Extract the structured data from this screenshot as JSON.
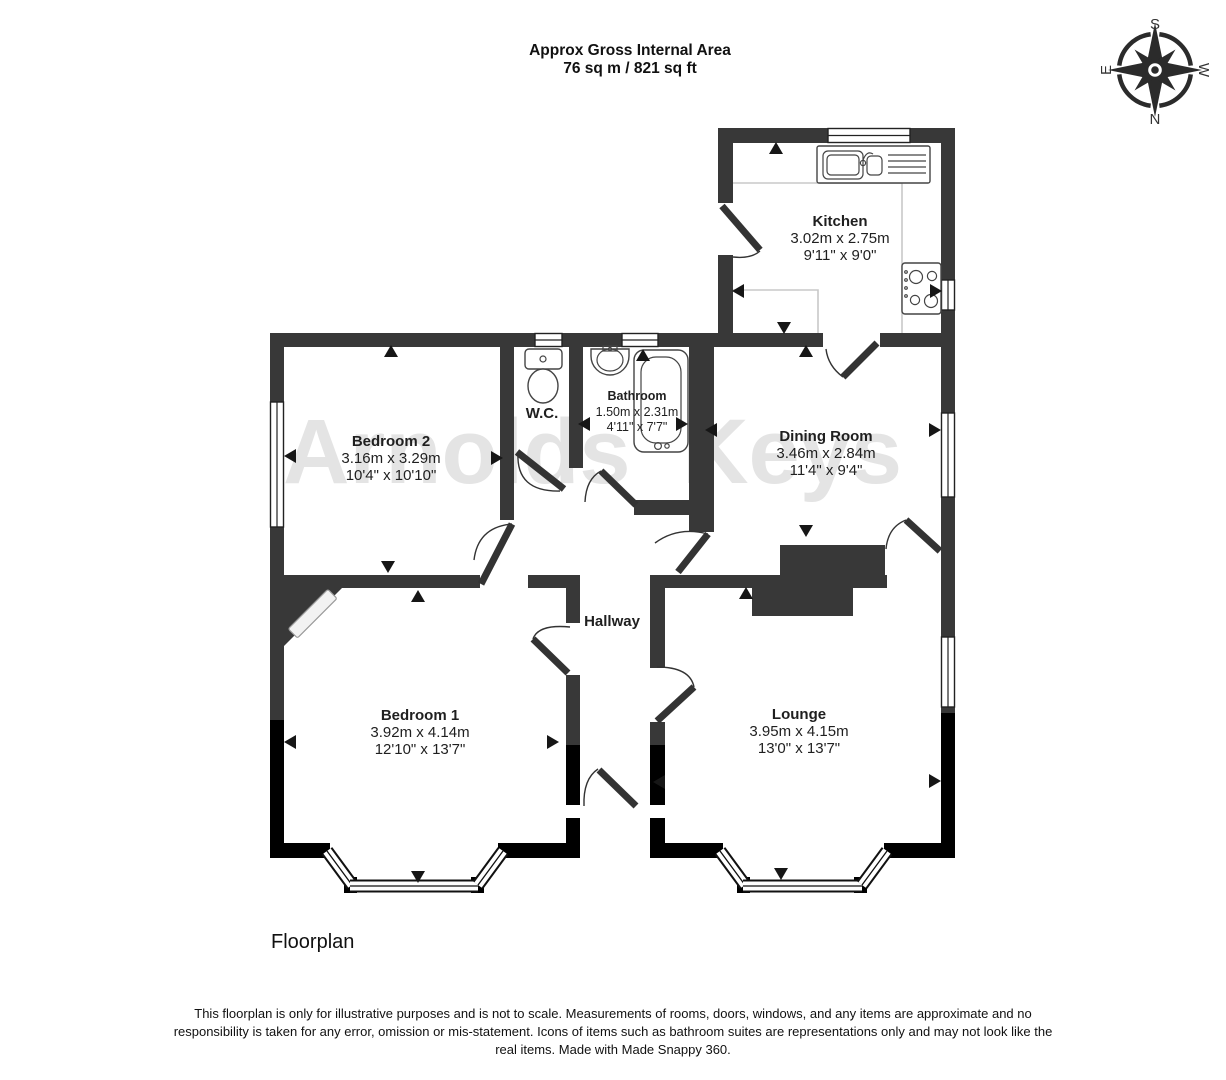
{
  "header": {
    "title_line1": "Approx Gross Internal Area",
    "title_line2": "76 sq m / 821 sq ft"
  },
  "compass": {
    "top": "S",
    "right": "W",
    "bottom": "N",
    "left": "E"
  },
  "watermark": "Arnolds Keys",
  "rooms": [
    {
      "name": "Kitchen",
      "metric": "3.02m x 2.75m",
      "imperial": "9'11\" x 9'0\""
    },
    {
      "name": "Bathroom",
      "metric": "1.50m x 2.31m",
      "imperial": "4'11\" x 7'7\""
    },
    {
      "name": "W.C."
    },
    {
      "name": "Bedroom 2",
      "metric": "3.16m x 3.29m",
      "imperial": "10'4\" x 10'10\""
    },
    {
      "name": "Dining Room",
      "metric": "3.46m x 2.84m",
      "imperial": "11'4\" x 9'4\""
    },
    {
      "name": "Hallway"
    },
    {
      "name": "Bedroom 1",
      "metric": "3.92m x 4.14m",
      "imperial": "12'10\" x 13'7\""
    },
    {
      "name": "Lounge",
      "metric": "3.95m x 4.15m",
      "imperial": "13'0\" x 13'7\""
    }
  ],
  "footer": {
    "caption": "Floorplan",
    "disclaimer": "This floorplan is only for illustrative purposes and is not to scale. Measurements of rooms, doors, windows, and any items are approximate and no responsibility is taken for any error, omission or mis-statement. Icons of items such as bathroom suites are representations only and may not look like the real items. Made with Made Snappy 360."
  },
  "colors": {
    "wall": "#383838",
    "wall_dark": "#000000",
    "watermark": "#e4e4e4"
  }
}
